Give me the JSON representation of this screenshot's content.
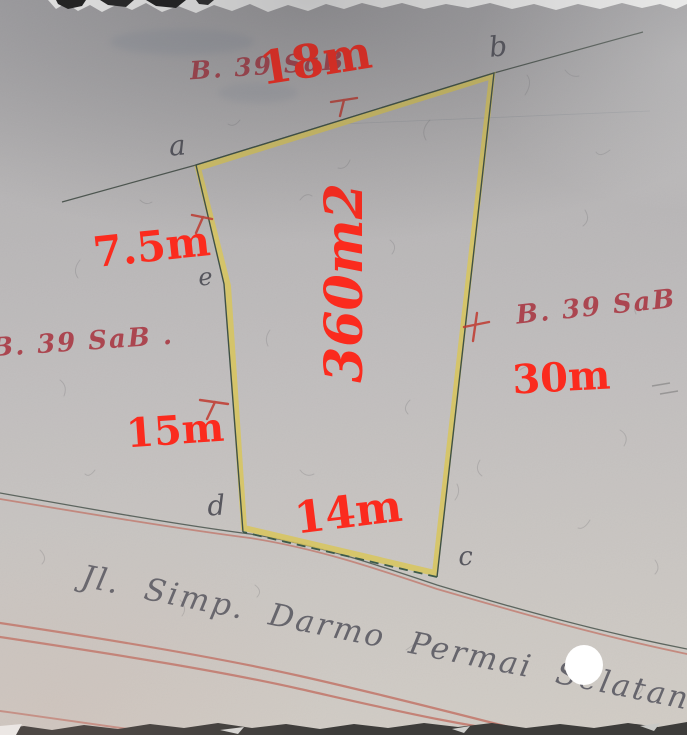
{
  "plot": {
    "area_label": "360m2",
    "dimensions": {
      "top": "18m",
      "left_upper": "7.5m",
      "left_lower": "15m",
      "right": "30m",
      "bottom": "14m"
    },
    "corners": {
      "a": "a",
      "b": "b",
      "c": "c",
      "d": "d",
      "e": "e"
    }
  },
  "handwritten": {
    "ref_top": "B. 39 SaB",
    "ref_left": "B. 39 SaB .",
    "ref_right": "B. 39 SaB ."
  },
  "street": {
    "label": "Jl. Simp. Darmo Permai Selatan"
  },
  "symbols": {
    "perpendicular_tick": "⊥",
    "white_dot_marker": "●"
  },
  "colors": {
    "measurement_red": "#fb2b1e",
    "handwritten_red": "#a93742",
    "plot_outline_yellow": "#d8c65c",
    "boundary_dark_green": "#3f5147",
    "road_line_red": "#c06f63",
    "pencil_gray": "#50505a",
    "paper_gray": "#c0bdbd"
  }
}
